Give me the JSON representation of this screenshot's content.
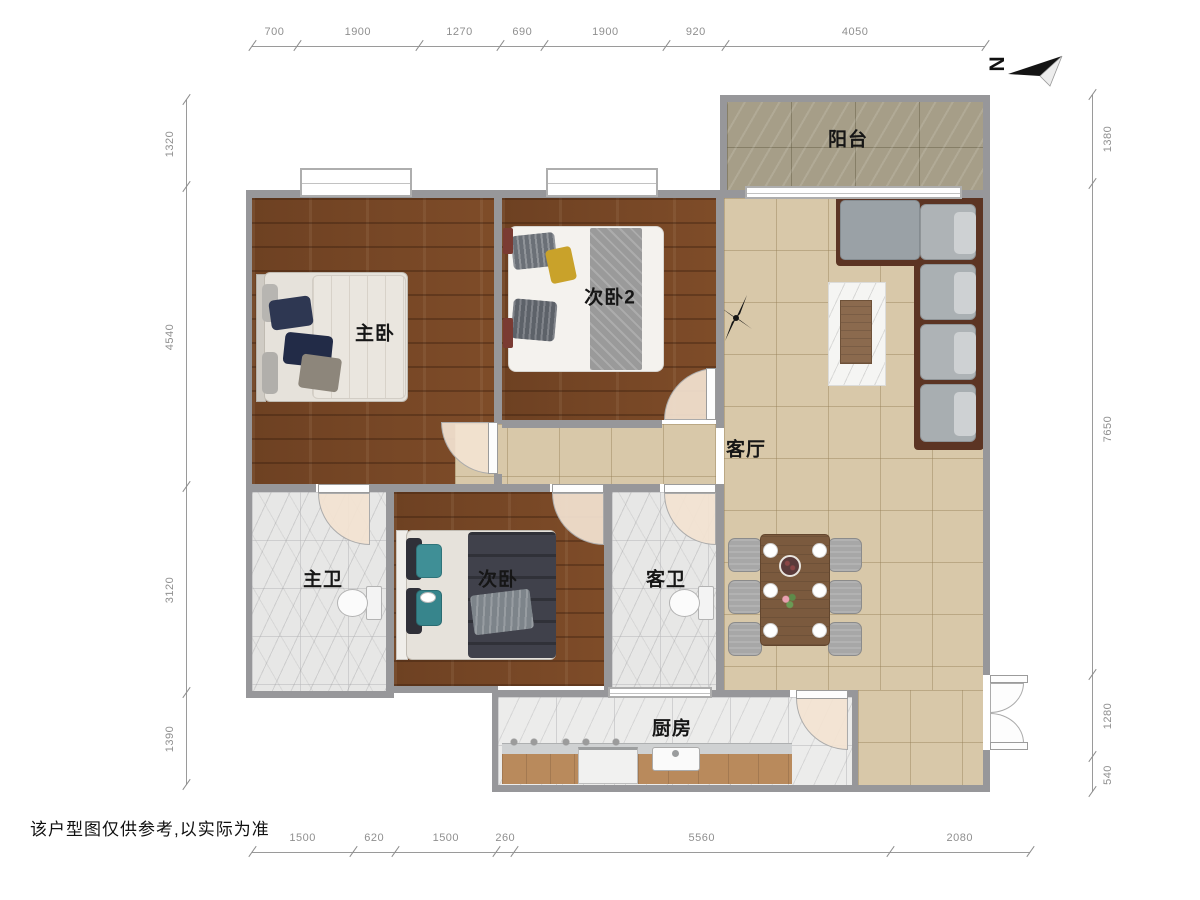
{
  "disclaimer": "该户型图仅供参考,以实际为准",
  "compass": {
    "label": "N"
  },
  "labels": {
    "balcony": "阳台",
    "master_bedroom": "主卧",
    "bedroom2": "次卧2",
    "living_room": "客厅",
    "master_bath": "主卫",
    "bedroom3": "次卧",
    "guest_bath": "客卫",
    "kitchen": "厨房"
  },
  "dimensions": {
    "top": [
      700,
      1900,
      1270,
      690,
      1900,
      920,
      4050
    ],
    "bottom": [
      1500,
      620,
      1500,
      260,
      5560,
      2080
    ],
    "left": [
      1320,
      4540,
      3120,
      1390
    ],
    "right": [
      1380,
      7650,
      1280,
      540
    ]
  },
  "icons": {
    "north_arrow": "paper-dart pointing left with rotated N",
    "ceiling_fan": "black fan silhouette in living room"
  },
  "colors": {
    "wall": "#97979a",
    "wood_floor": "#7b4a28",
    "living_tile": "#d8c8a9",
    "balcony_tile": "#a69e88",
    "marble": "#e8e8e7",
    "door_swing": "#f3e3d1",
    "sofa_gray": "#a7adb0",
    "sofa_frame": "#5c3423",
    "dining_table": "#7b5a3e",
    "teal_pillow": "#3f8f96",
    "navy_pillow": "#2e3752"
  }
}
